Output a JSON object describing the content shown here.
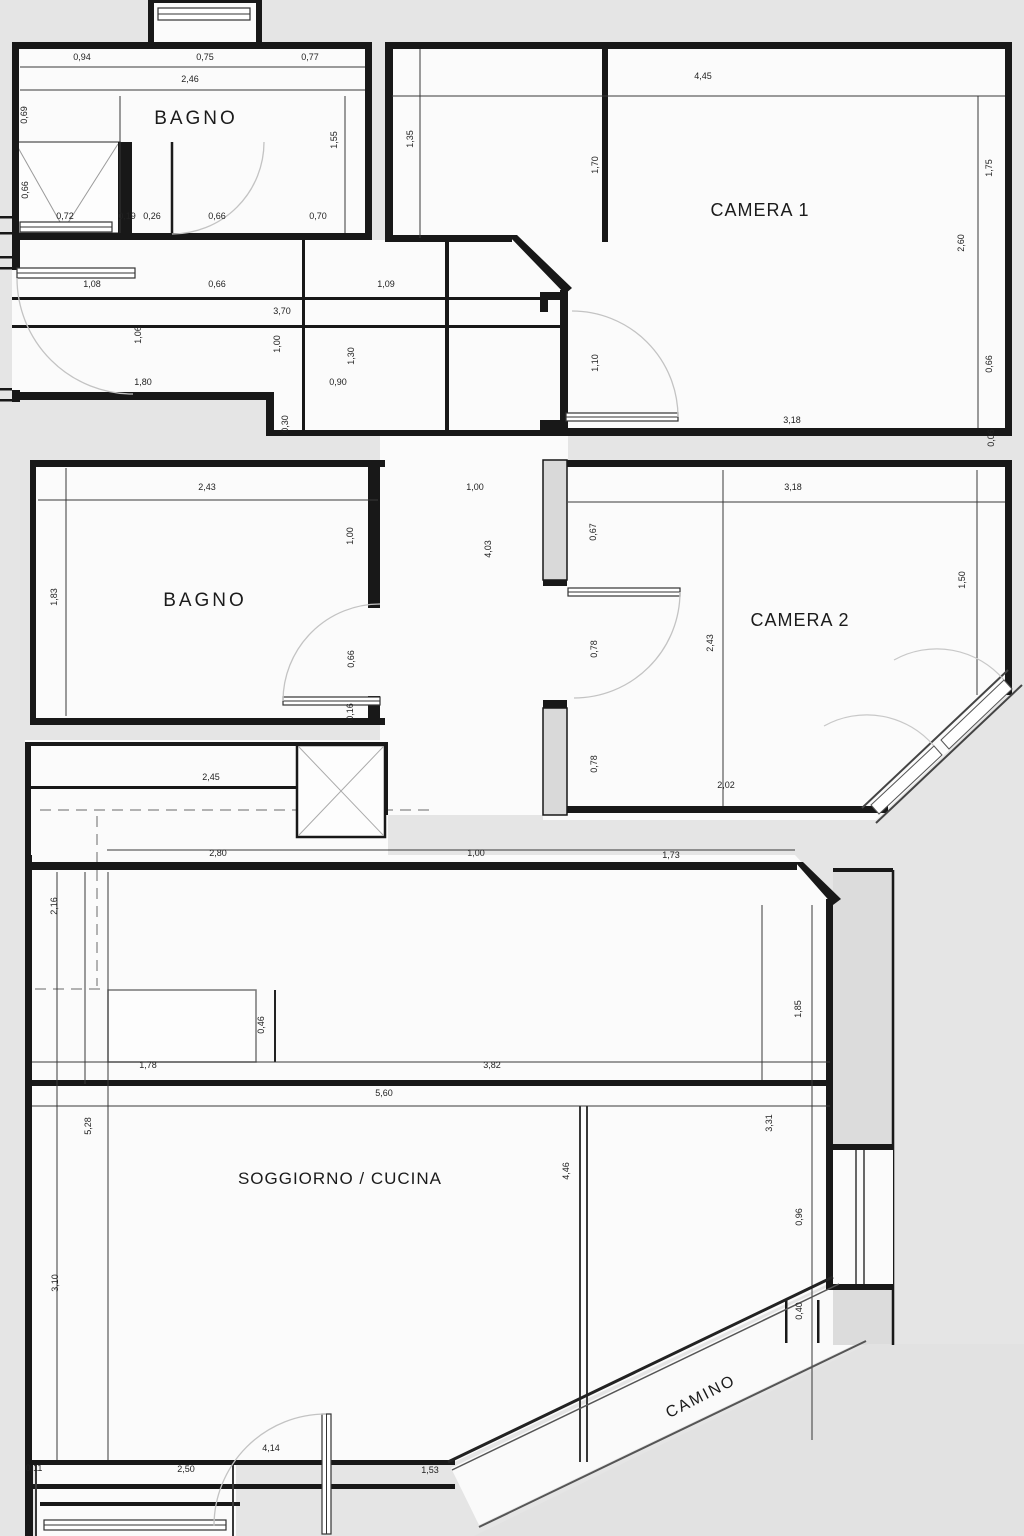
{
  "colors": {
    "background": "#e5e5e5",
    "wall": "#181818",
    "thin_line": "#383838",
    "door_arc": "#c3c3c3",
    "furniture": "#8c8c8c",
    "room_fill": "#fbfbfb"
  },
  "rooms": [
    {
      "id": "bagno-1",
      "label": "BAGNO"
    },
    {
      "id": "camera-1",
      "label": "CAMERA 1"
    },
    {
      "id": "bagno-2",
      "label": "BAGNO"
    },
    {
      "id": "camera-2",
      "label": "CAMERA 2"
    },
    {
      "id": "soggiorno-cucina",
      "label": "SOGGIORNO / CUCINA"
    },
    {
      "id": "camino",
      "label": "CAMINO"
    }
  ],
  "dims": [
    "0,94",
    "0,75",
    "0,77",
    "2,46",
    "0,69",
    "0,66",
    "1,55",
    "0,72",
    "0,19",
    "0,26",
    "0,66",
    "0,70",
    "1,35",
    "1,70",
    "4,45",
    "1,75",
    "2,60",
    "0,66",
    "0,06",
    "1,10",
    "3,18",
    "1,08",
    "0,66",
    "1,09",
    "3,70",
    "1,06",
    "1,00",
    "1,30",
    "1,80",
    "0,90",
    "0,30",
    "2,43",
    "1,00",
    "3,18",
    "1,83",
    "1,00",
    "4,03",
    "0,67",
    "1,50",
    "0,66",
    "0,78",
    "2,43",
    "0,16",
    "0,78",
    "2,02",
    "2,45",
    "2,80",
    "1,00",
    "1,73",
    "2,16",
    "0,46",
    "1,78",
    "3,82",
    "5,60",
    "5,28",
    "1,85",
    "3,31",
    "3,10",
    "4,46",
    "0,96",
    "0,40",
    "4,14",
    "0,11",
    "2,50",
    "1,53"
  ]
}
